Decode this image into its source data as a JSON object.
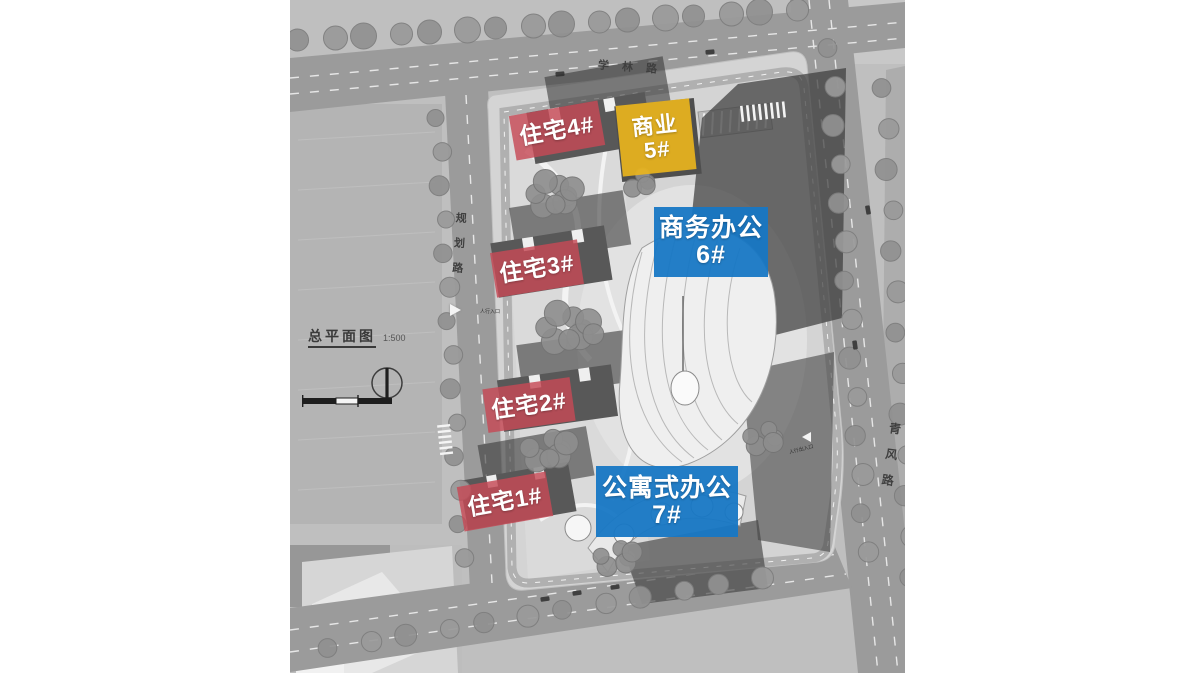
{
  "drawing": {
    "title": "总平面图",
    "scale": "1:500"
  },
  "roads": {
    "north": "学林路",
    "west": "规划路",
    "east": "青风路"
  },
  "legend_colors": {
    "residential": "#c64955",
    "commercial": "#e8b41e",
    "office": "#1777c4"
  },
  "buildings": [
    {
      "label": "住宅4#",
      "category": "residential"
    },
    {
      "label": "商业",
      "number": "5#",
      "category": "commercial"
    },
    {
      "label": "商务办公",
      "number": "6#",
      "category": "office"
    },
    {
      "label": "住宅3#",
      "category": "residential"
    },
    {
      "label": "住宅2#",
      "category": "residential"
    },
    {
      "label": "住宅1#",
      "category": "residential"
    },
    {
      "label": "公寓式办公",
      "number": "7#",
      "category": "office"
    }
  ],
  "annotations": {
    "pedestrian_entrance": "人行入口",
    "pedestrian_access": "人行出入口"
  }
}
